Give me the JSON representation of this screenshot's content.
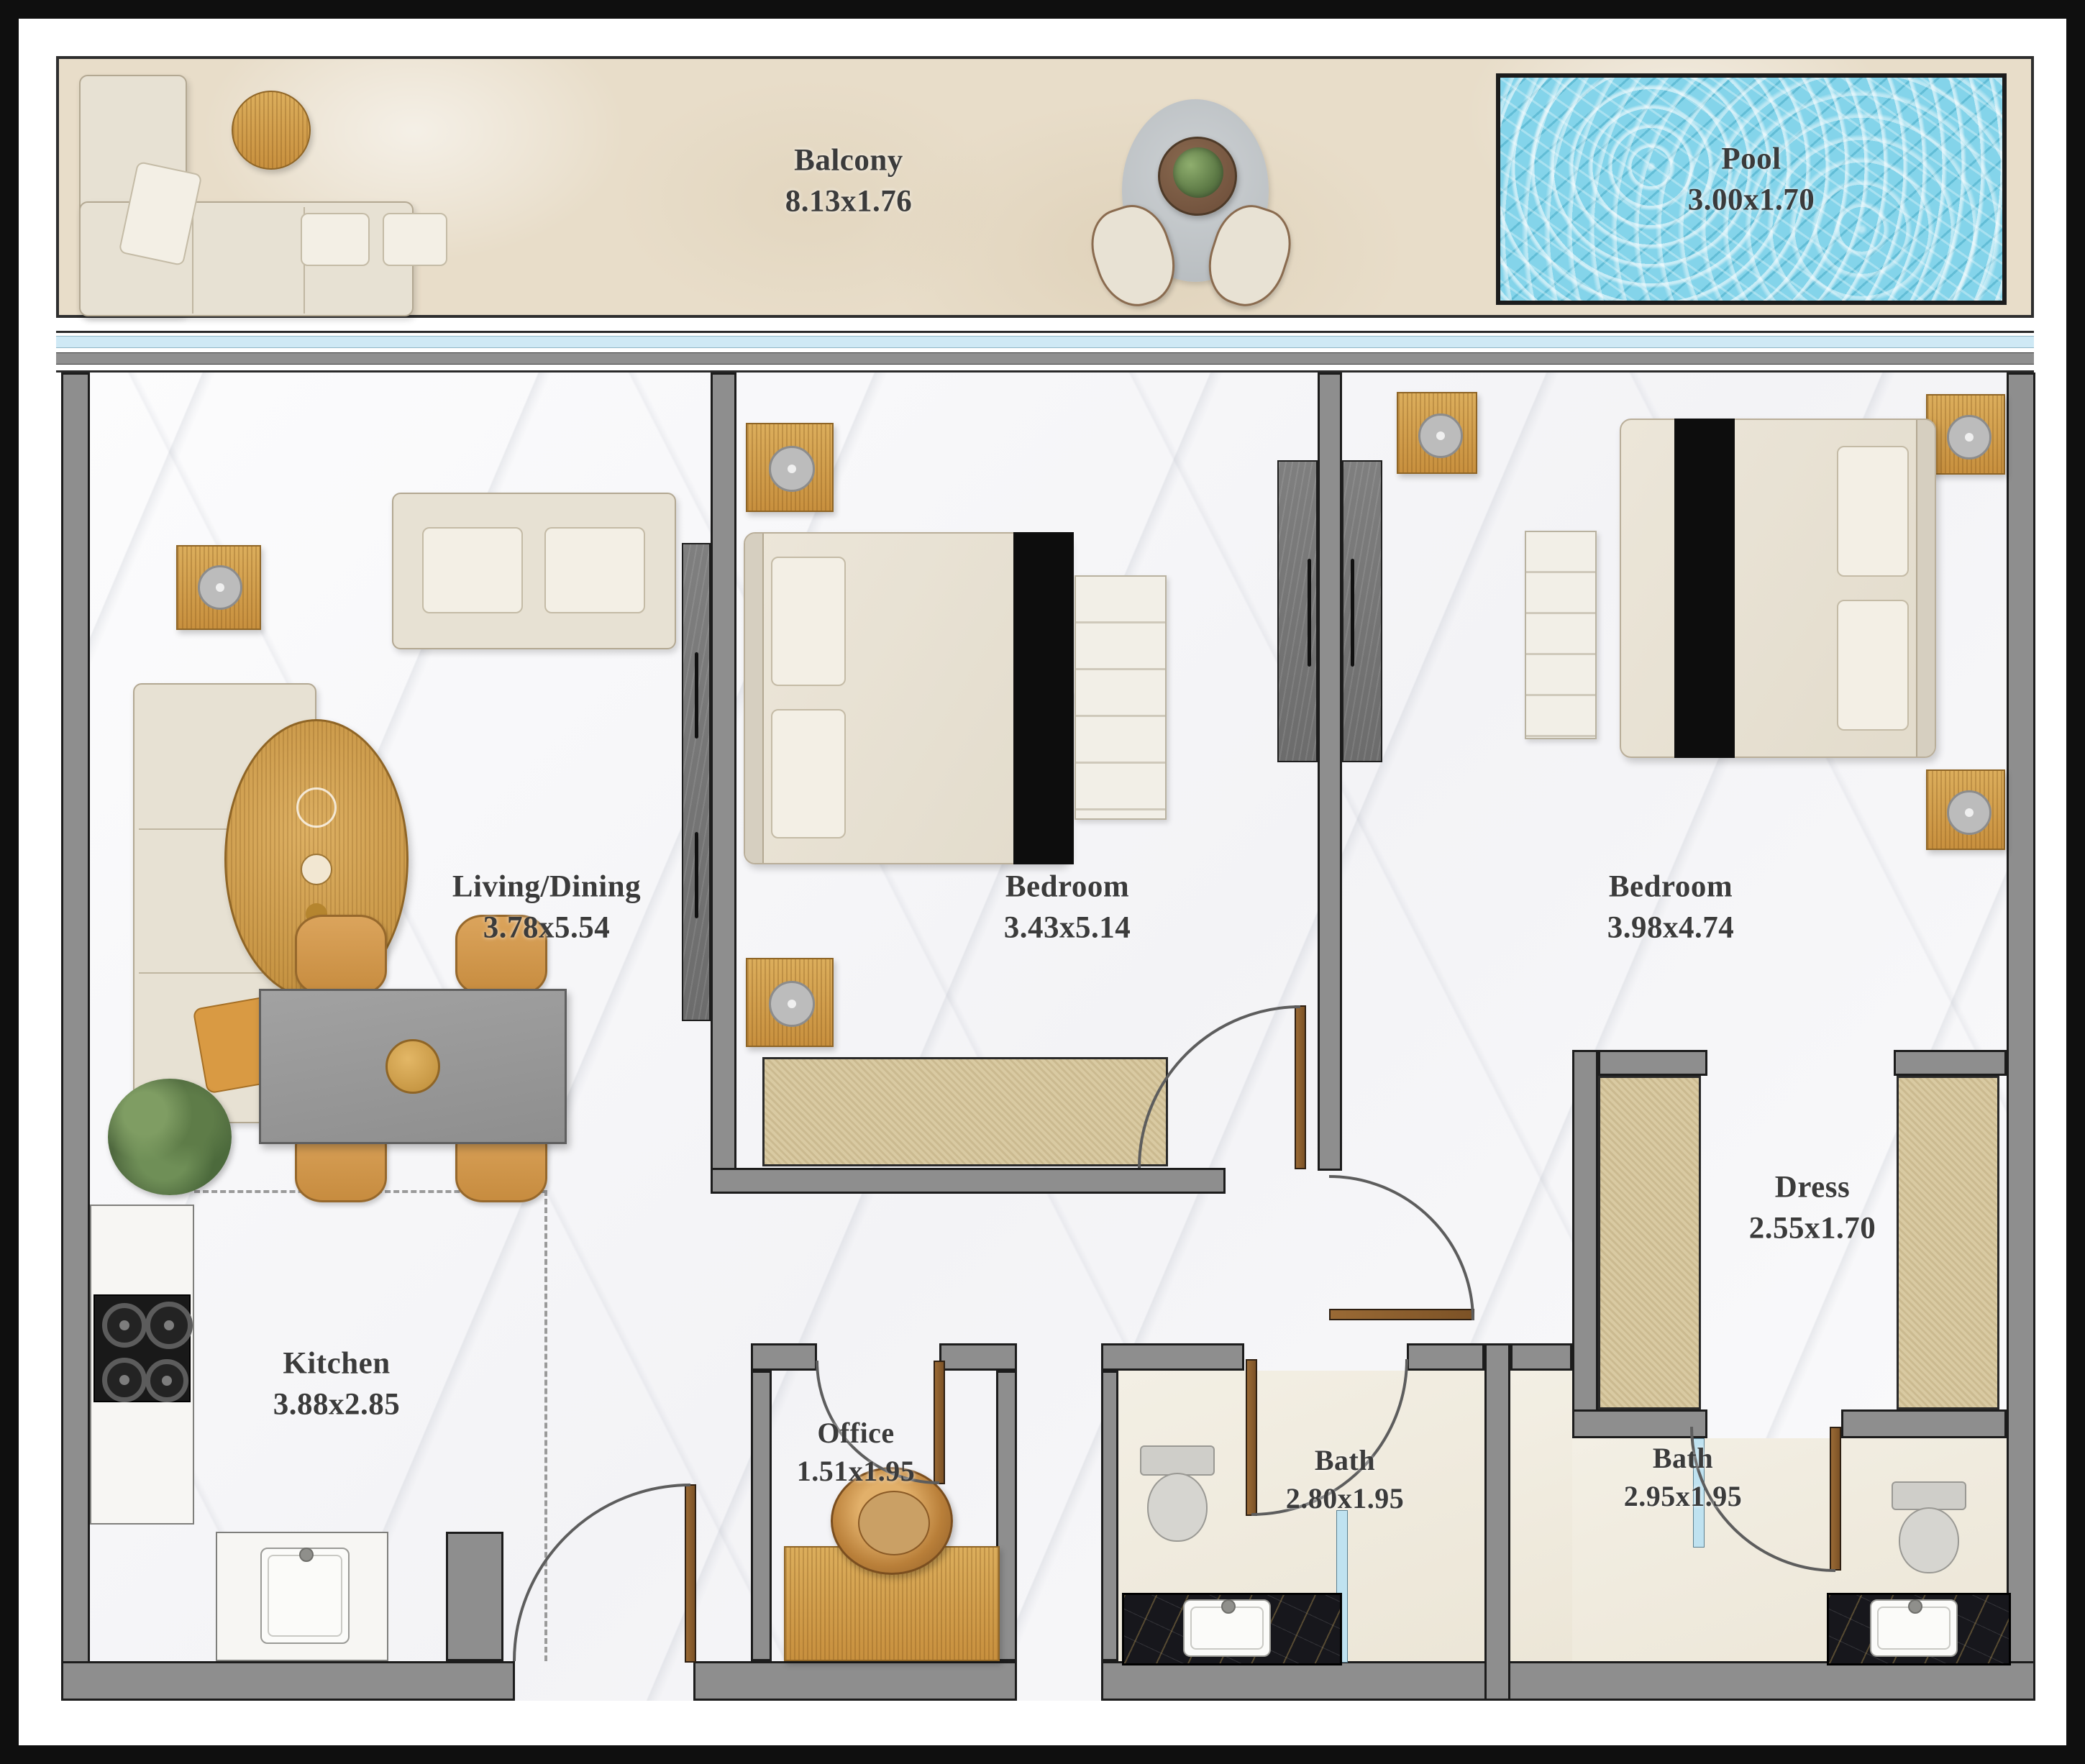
{
  "floorplan": {
    "rooms": [
      {
        "id": "balcony",
        "label": "Balcony",
        "dims": "8.13x1.76"
      },
      {
        "id": "pool",
        "label": "Pool",
        "dims": "3.00x1.70"
      },
      {
        "id": "living_dining",
        "label": "Living/Dining",
        "dims": "3.78x5.54"
      },
      {
        "id": "bedroom_1",
        "label": "Bedroom",
        "dims": "3.43x5.14"
      },
      {
        "id": "bedroom_2",
        "label": "Bedroom",
        "dims": "3.98x4.74"
      },
      {
        "id": "dress",
        "label": "Dress",
        "dims": "2.55x1.70"
      },
      {
        "id": "kitchen",
        "label": "Kitchen",
        "dims": "3.88x2.85"
      },
      {
        "id": "office",
        "label": "Office",
        "dims": "1.51x1.95"
      },
      {
        "id": "bath_1",
        "label": "Bath",
        "dims": "2.80x1.95"
      },
      {
        "id": "bath_2",
        "label": "Bath",
        "dims": "2.95x1.95"
      }
    ],
    "colors": {
      "wall": "#8e8e8e",
      "wall_outline": "#1c1c1c",
      "pool_water": "#84d4ea",
      "balcony_floor": "#e8ddc9",
      "gold_accent": "#d2a254",
      "door_leaf": "#8a5a2d",
      "marble_floor": "#fafafb",
      "bath_floor": "#f0ebdf",
      "vanity_marble": "#17171c"
    }
  }
}
